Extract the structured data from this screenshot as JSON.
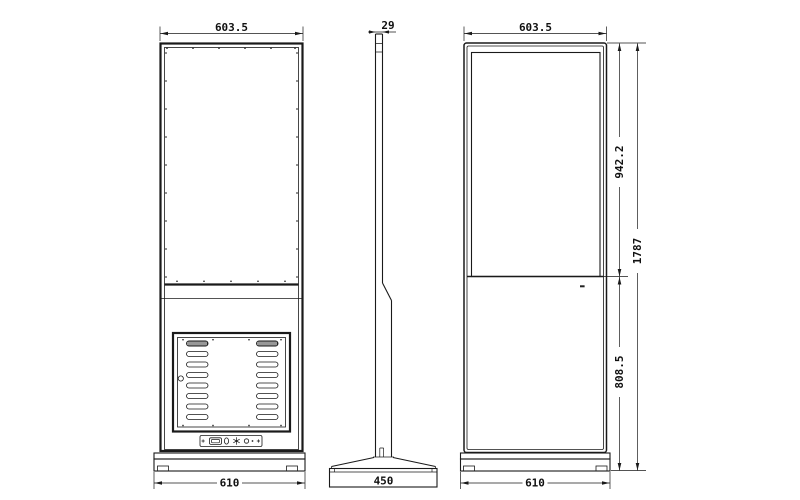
{
  "colors": {
    "line": "#1a1a1a",
    "background": "#ffffff"
  },
  "views": {
    "back": {
      "dim_width_top": "603.5",
      "dim_width_base": "610"
    },
    "side": {
      "dim_thickness": "29",
      "dim_base_depth": "450"
    },
    "front": {
      "dim_width_top": "603.5",
      "dim_screen_section_height": "942.2",
      "dim_lower_section_height": "808.5",
      "dim_total_height": "1787",
      "dim_width_base": "610"
    }
  }
}
